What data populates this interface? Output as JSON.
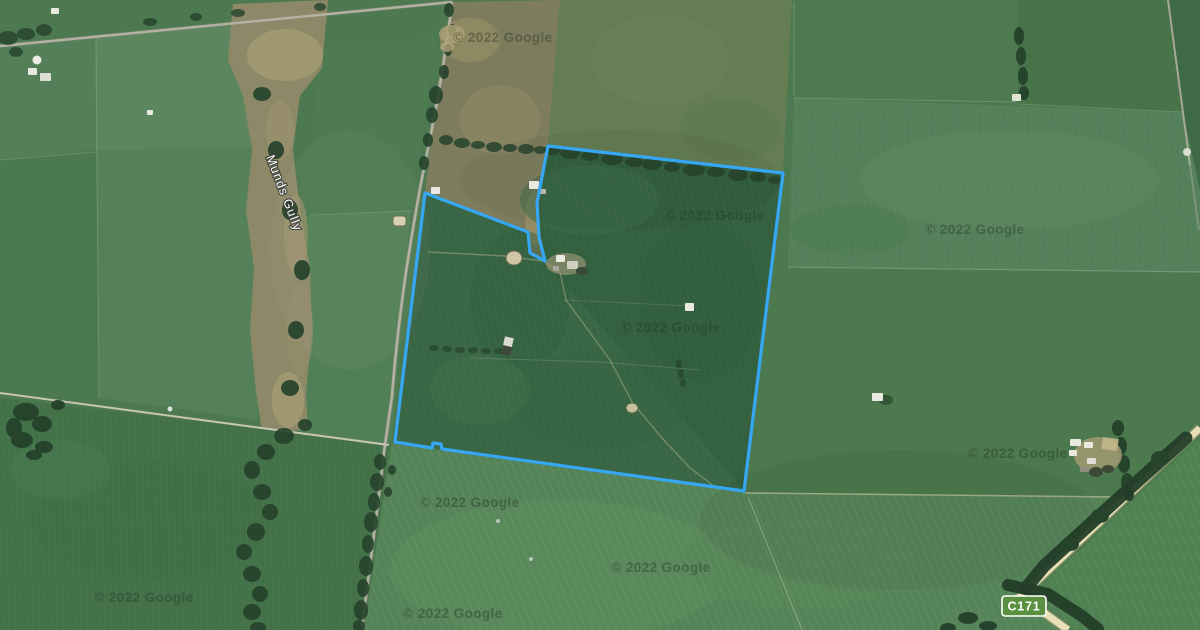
{
  "map": {
    "type": "satellite-imagery",
    "provider_attribution": "© 2022 Google",
    "labels": {
      "waterway": "Munds Gully",
      "route_shield": "C171"
    },
    "colors": {
      "parcel_boundary": "#36A7F5",
      "route_shield_fill": "#5A9140",
      "route_shield_text": "#FFFFFF",
      "road_surface_tan": "#E9DFB6",
      "field_green": "#4D7950",
      "tree_green": "#26432C",
      "gully_brown": "#8D8867"
    },
    "parcel": {
      "points": "548,146 783,173 744,491 442,449 441,444 433,443 432,448 395,442 425,193 528,232 530,253 545,261 539,237 537,203",
      "stroke_width": 3.2
    },
    "watermarks": [
      {
        "text": "© 2022 Google",
        "x": 503,
        "y": 42
      },
      {
        "text": "© 2022 Google",
        "x": 715,
        "y": 220
      },
      {
        "text": "© 2022 Google",
        "x": 671,
        "y": 332
      },
      {
        "text": "© 2022 Google",
        "x": 975,
        "y": 234
      },
      {
        "text": "© 2022 Google",
        "x": 1018,
        "y": 458
      },
      {
        "text": "© 2022 Google",
        "x": 470,
        "y": 507
      },
      {
        "text": "© 2022 Google",
        "x": 661,
        "y": 572
      },
      {
        "text": "© 2022 Google",
        "x": 144,
        "y": 602
      },
      {
        "text": "© 2022 Google",
        "x": 453,
        "y": 618
      }
    ]
  }
}
